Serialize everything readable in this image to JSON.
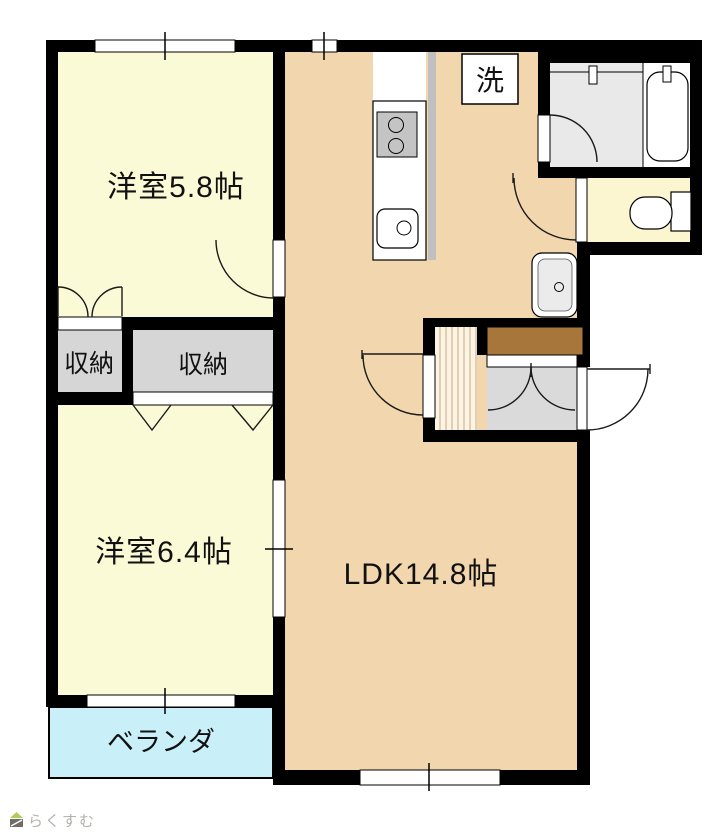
{
  "floorplan": {
    "rooms": {
      "western_room_top": {
        "label": "洋室5.8帖"
      },
      "western_room_bottom": {
        "label": "洋室6.4帖"
      },
      "ldk": {
        "label": "LDK14.8帖"
      },
      "storage_left": {
        "label": "収納"
      },
      "storage_right": {
        "label": "収納"
      },
      "laundry": {
        "label": "洗"
      },
      "veranda": {
        "label": "ベランダ"
      }
    },
    "watermark": {
      "brand": "らくすむ"
    },
    "colors": {
      "wall": "#000000",
      "western_room_fill": "#FBFAD7",
      "ldk_fill": "#F2D7AE",
      "storage_fill": "#D6D6D6",
      "bathroom_fill": "#E9E9E9",
      "toilet_fill": "#FBF5D0",
      "genkan_tile_fill": "#DADADA",
      "shoe_cabinet_fill": "#A6763B",
      "hall_floor_fill": "#FBF4E4",
      "hall_floor_stripe": "#C8A87C",
      "veranda_fill": "#C9F0F8",
      "counter_edge": "#C0C0C0",
      "stove_fill": "#C4C4C4",
      "watermark_text": "#B3B1AB",
      "watermark_logo_green": "#AFCC5F",
      "watermark_logo_gray": "#6E6E66"
    }
  }
}
